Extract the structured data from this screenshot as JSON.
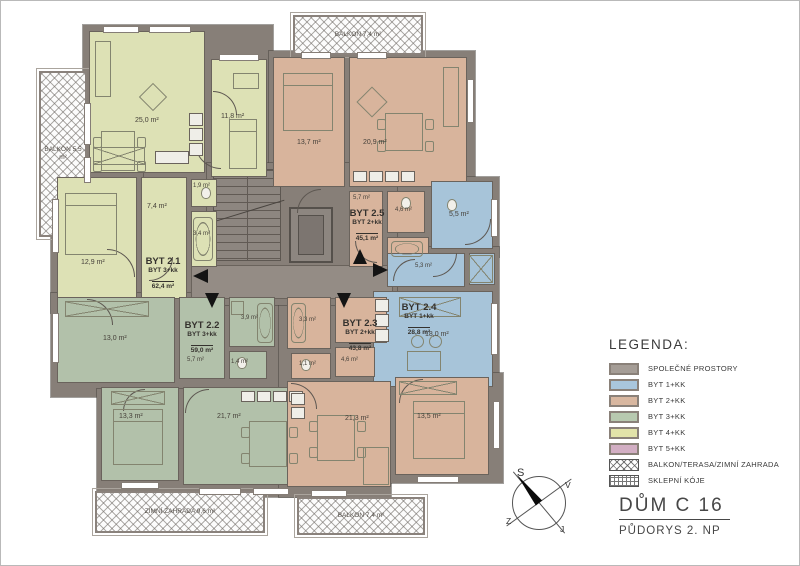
{
  "titleblock": {
    "title": "DŮM C 16",
    "subtitle": "PŮDORYS 2. NP"
  },
  "compass": {
    "north": "S",
    "east": "V",
    "west": "Z",
    "south": "J"
  },
  "legend": {
    "title": "LEGENDA:",
    "items": [
      {
        "label": "SPOLEČNÉ PROSTORY",
        "color": "#a59d96"
      },
      {
        "label": "BYT 1+KK",
        "color": "#a9c6dc"
      },
      {
        "label": "BYT 2+KK",
        "color": "#d8b7a0"
      },
      {
        "label": "BYT 3+KK",
        "color": "#b7c9af"
      },
      {
        "label": "BYT 4+KK",
        "color": "#e2e3a9"
      },
      {
        "label": "BYT 5+KK",
        "color": "#d2aec3"
      },
      {
        "label": "BALKON/TERASA/ZIMNÍ ZAHRADA",
        "pattern": "crosshatch"
      },
      {
        "label": "SKLEPNÍ KÓJE",
        "pattern": "grid"
      }
    ]
  },
  "apartments": [
    {
      "name": "BYT 2.1",
      "type": "BYT 3+kk",
      "area": "62,4 m²"
    },
    {
      "name": "BYT 2.2",
      "type": "BYT 3+kk",
      "area": "59,0 m²"
    },
    {
      "name": "BYT 2.3",
      "type": "BYT 2+kk",
      "area": "43,8 m²"
    },
    {
      "name": "BYT 2.4",
      "type": "BYT 1+kk",
      "area": "28,8 m²"
    },
    {
      "name": "BYT 2.5",
      "type": "BYT 2+kk",
      "area": "45,1 m²"
    }
  ],
  "rooms": {
    "a21_living": "25,0 m²",
    "a21_bed1": "11,8 m²",
    "a21_bed2": "12,9 m²",
    "a21_hall": "7,4 m²",
    "a21_wc": "1,9 m²",
    "a21_bath": "3,4 m²",
    "a25_bed": "13,7 m²",
    "a25_living": "20,9 m²",
    "a25_hall": "5,7 m²",
    "a25_wc": "4,6 m²",
    "a24_bath": "5,5 m²",
    "a24_hall": "5,3 m²",
    "a24_living": "18,0 m²",
    "a22_bed1": "13,0 m²",
    "a22_hall": "5,7 m²",
    "a22_bath": "3,9 m²",
    "a22_wc": "1,4 m²",
    "a22_bed2": "13,3 m²",
    "a22_living": "21,7 m²",
    "a23_bath": "3,3 m²",
    "a23_wc": "1,1 m²",
    "a23_hall": "4,6 m²",
    "a23_living": "21,3 m²",
    "a23_bed": "13,5 m²"
  },
  "balconies": {
    "left": "BALKON 5,5 m²",
    "top": "BALKON 7,4 m²",
    "bottom_left": "ZIMNÍ ZAHRADA 9,6 m²",
    "bottom_right": "BALKON 7,4 m²"
  },
  "colors": {
    "wall": "#877f78",
    "common": "#a59d96",
    "byt1": "#a9c6dc",
    "byt2": "#d8b7a0",
    "byt3": "#b7c9af",
    "byt4": "#e2e3a9",
    "byt5": "#d2aec3",
    "plan_a21": "#dde1b5",
    "plan_a22": "#b2c1aa",
    "plan_a23": "#d8b49c",
    "plan_a24": "#a7c4d9",
    "plan_a25": "#d8b49c"
  }
}
